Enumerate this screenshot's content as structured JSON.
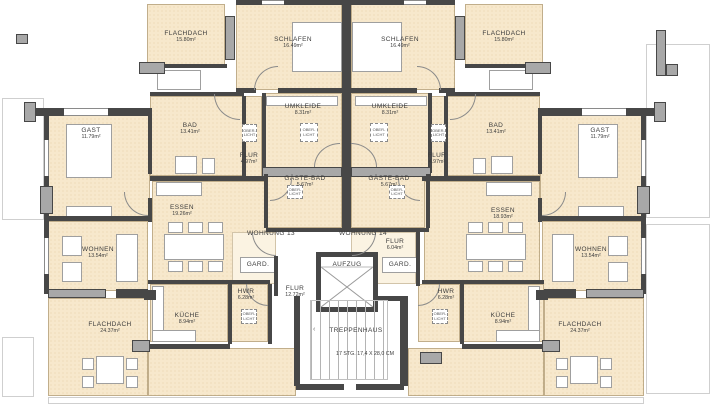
{
  "rooms": {
    "flachdach_tl": {
      "name": "FLACHDACH",
      "area": "15.80m²"
    },
    "schlafen_l": {
      "name": "SCHLAFEN",
      "area": "16.49m²"
    },
    "schlafen_r": {
      "name": "SCHLAFEN",
      "area": "16.49m²"
    },
    "flachdach_tr": {
      "name": "FLACHDACH",
      "area": "15.80m²"
    },
    "gast_l": {
      "name": "GAST",
      "area": "11.79m²"
    },
    "bad_l": {
      "name": "BAD",
      "area": "13.41m²"
    },
    "umkleide_l": {
      "name": "UMKLEIDE",
      "area": "8.31m²"
    },
    "umkleide_r": {
      "name": "UMKLEIDE",
      "area": "8.31m²"
    },
    "bad_r": {
      "name": "BAD",
      "area": "13.41m²"
    },
    "gast_r": {
      "name": "GAST",
      "area": "11.79m²"
    },
    "flur_bad_l": {
      "name": "FLUR",
      "area": "4.97m²"
    },
    "flur_bad_r": {
      "name": "FLUR",
      "area": "4.97m²"
    },
    "gaestebad_l": {
      "name": "GÄSTE-BAD",
      "area": "5.67m²"
    },
    "gaestebad_r": {
      "name": "GÄSTE-BAD",
      "area": "5.67m²"
    },
    "essen_l": {
      "name": "ESSEN",
      "area": "19.26m²"
    },
    "essen_r": {
      "name": "ESSEN",
      "area": "18.93m²"
    },
    "wohnung13": {
      "name": "WOHNUNG 13"
    },
    "wohnung14": {
      "name": "WOHNUNG 14"
    },
    "flur_14": {
      "name": "FLUR",
      "area": "6.04m²"
    },
    "wohnen_l": {
      "name": "WOHNEN",
      "area": "13.54m²"
    },
    "wohnen_r": {
      "name": "WOHNEN",
      "area": "13.54m²"
    },
    "gard_l": {
      "name": "GARD."
    },
    "gard_r": {
      "name": "GARD."
    },
    "aufzug": {
      "name": "AUFZUG"
    },
    "hwr_l": {
      "name": "HWR",
      "area": "6.28m²"
    },
    "hwr_r": {
      "name": "HWR",
      "area": "6.28m²"
    },
    "flur_zentral": {
      "name": "FLUR",
      "area": "12.72m²"
    },
    "kueche_l": {
      "name": "KÜCHE",
      "area": "8.94m²"
    },
    "kueche_r": {
      "name": "KÜCHE",
      "area": "8.94m²"
    },
    "flachdach_bl": {
      "name": "FLACHDACH",
      "area": "24.37m²"
    },
    "flachdach_br": {
      "name": "FLACHDACH",
      "area": "24.37m²"
    },
    "treppenhaus": {
      "name": "TREPPENHAUS",
      "detail": "17 STG.  17,4 X 28,0 CM"
    },
    "oberlicht": {
      "line1": "OBER-",
      "line2": "LICHT"
    }
  },
  "colors": {
    "room_fill": "#f7e8cc",
    "room_dot": "#e7d2a8",
    "entry_fill": "#fbf3e2",
    "wall_dark": "#474747",
    "wall_gray": "#a8a8a8",
    "thin_line": "#cfcfcf",
    "text": "#3d3d3d"
  }
}
